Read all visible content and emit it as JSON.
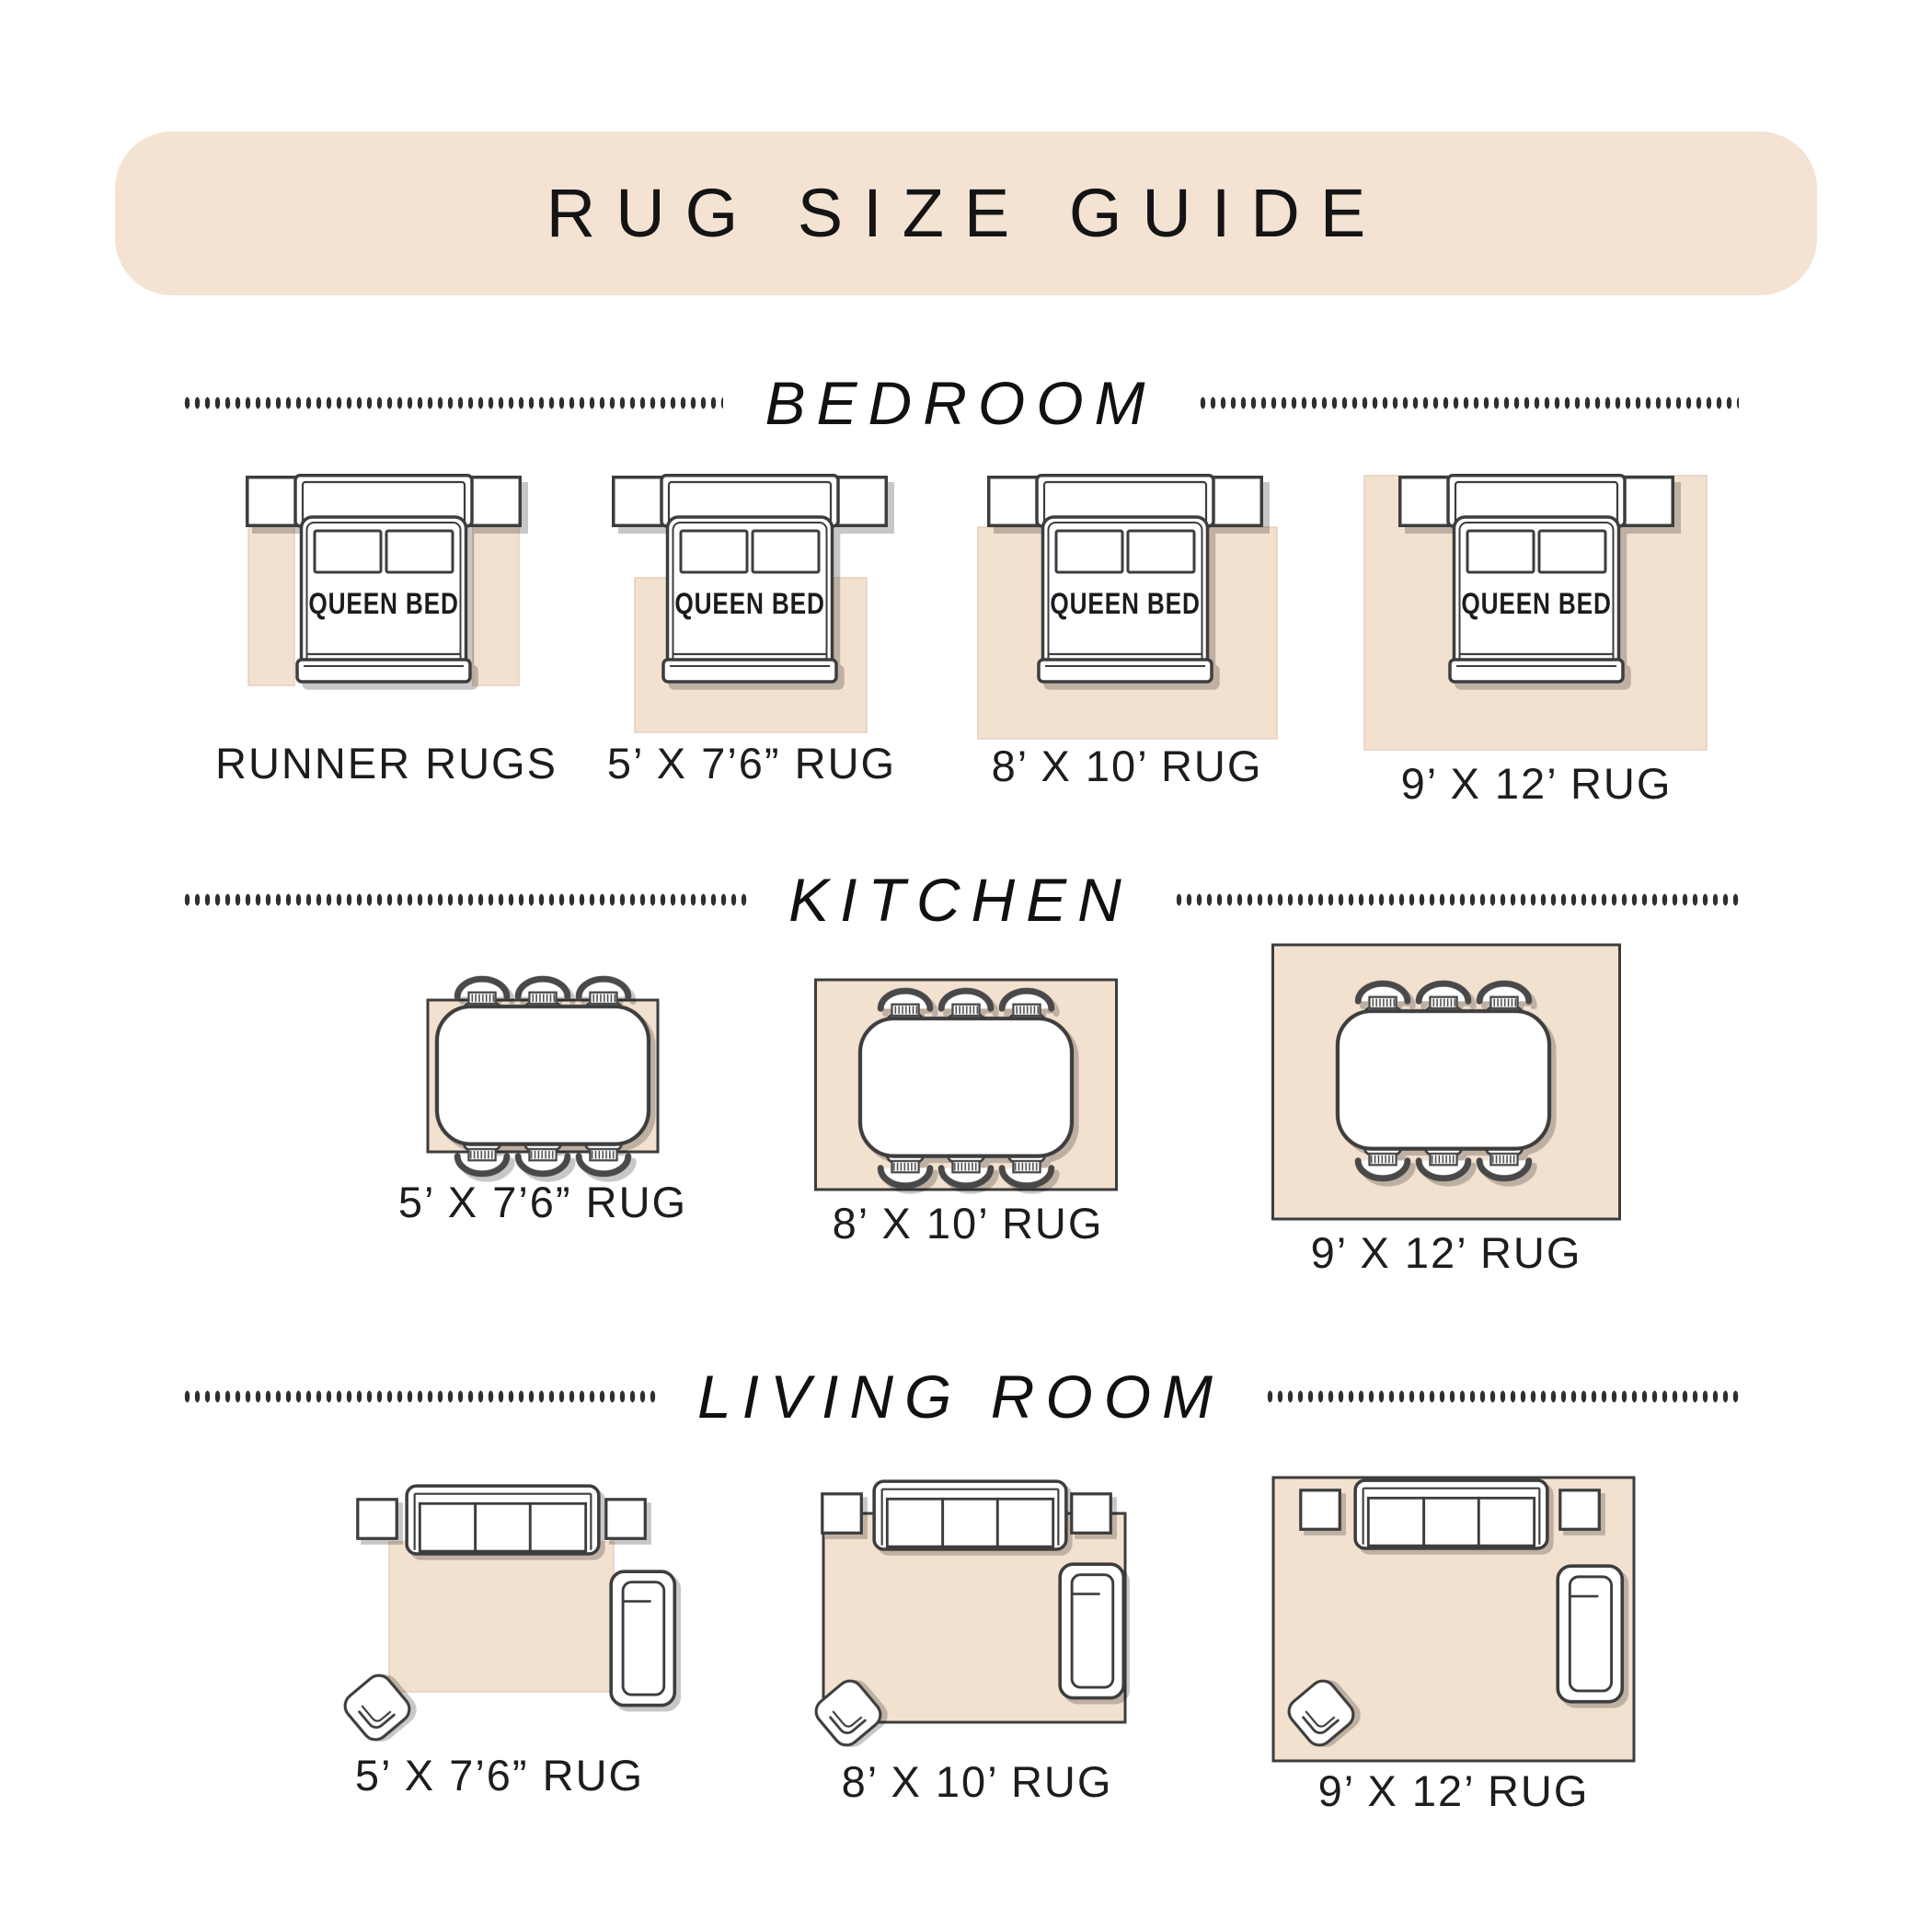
{
  "title": "RUG SIZE GUIDE",
  "bed_label": "QUEEN BED",
  "sections": {
    "bedroom": {
      "label": "BEDROOM",
      "items": [
        {
          "label": "RUNNER RUGS"
        },
        {
          "label": "5’ X 7’6” RUG"
        },
        {
          "label": "8’ X 10’ RUG"
        },
        {
          "label": "9’ X 12’ RUG"
        }
      ]
    },
    "kitchen": {
      "label": "KITCHEN",
      "items": [
        {
          "label": "5’ X 7’6” RUG"
        },
        {
          "label": "8’ X 10’ RUG"
        },
        {
          "label": "9’ X 12’ RUG"
        }
      ]
    },
    "living_room": {
      "label": "LIVING ROOM",
      "items": [
        {
          "label": "5’ X 7’6” RUG"
        },
        {
          "label": "8’ X 10’ RUG"
        },
        {
          "label": "9’ X 12’ RUG"
        }
      ]
    }
  },
  "icons": {
    "queen_bed": "bed-icon",
    "nightstand": "nightstand-icon",
    "runner_rug": "runner-rug-icon",
    "area_rug": "area-rug-icon",
    "dining_table": "dining-table-icon",
    "dining_chair": "dining-chair-icon",
    "sofa": "sofa-icon",
    "side_table": "side-table-icon",
    "lounge_chair": "lounge-chair-icon",
    "accent_chair": "accent-chair-icon"
  },
  "colors": {
    "banner": "#f4e3d3",
    "rug": "#f3e1d0",
    "rug_edge": "#e6d0bd",
    "outline": "#3d3d3d",
    "chair_dark": "#4a4a4a",
    "text": "#1d1d1d"
  }
}
